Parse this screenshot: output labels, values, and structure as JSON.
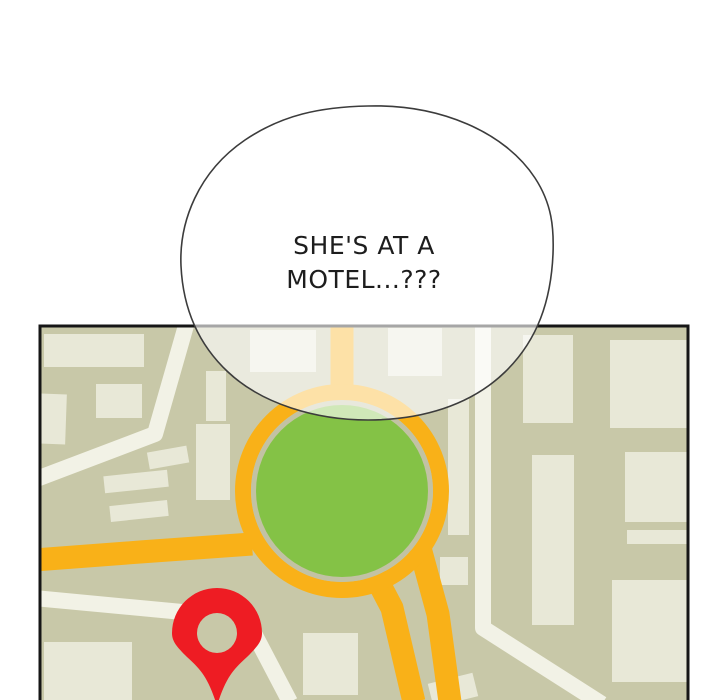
{
  "speech_bubble": {
    "line1": "SHE'S AT A",
    "line2": "MOTEL...???"
  },
  "icons": {
    "location_pin": "location-pin-icon"
  },
  "colors": {
    "page_background": "#ffffff",
    "map_background": "#c8c8a8",
    "ring_gap": "#c2c2a4",
    "building": "#e8e8d7",
    "road_white": "#f2f2e6",
    "road_orange": "#f9b118",
    "park_green": "#84c246",
    "park_green_washed": "#cfe4ba",
    "pin_red": "#ee1c23",
    "map_border": "#161616",
    "bubble_outline": "#3c3c3c",
    "bubble_fill_alpha": "0.62",
    "text": "#1d1d1d"
  }
}
